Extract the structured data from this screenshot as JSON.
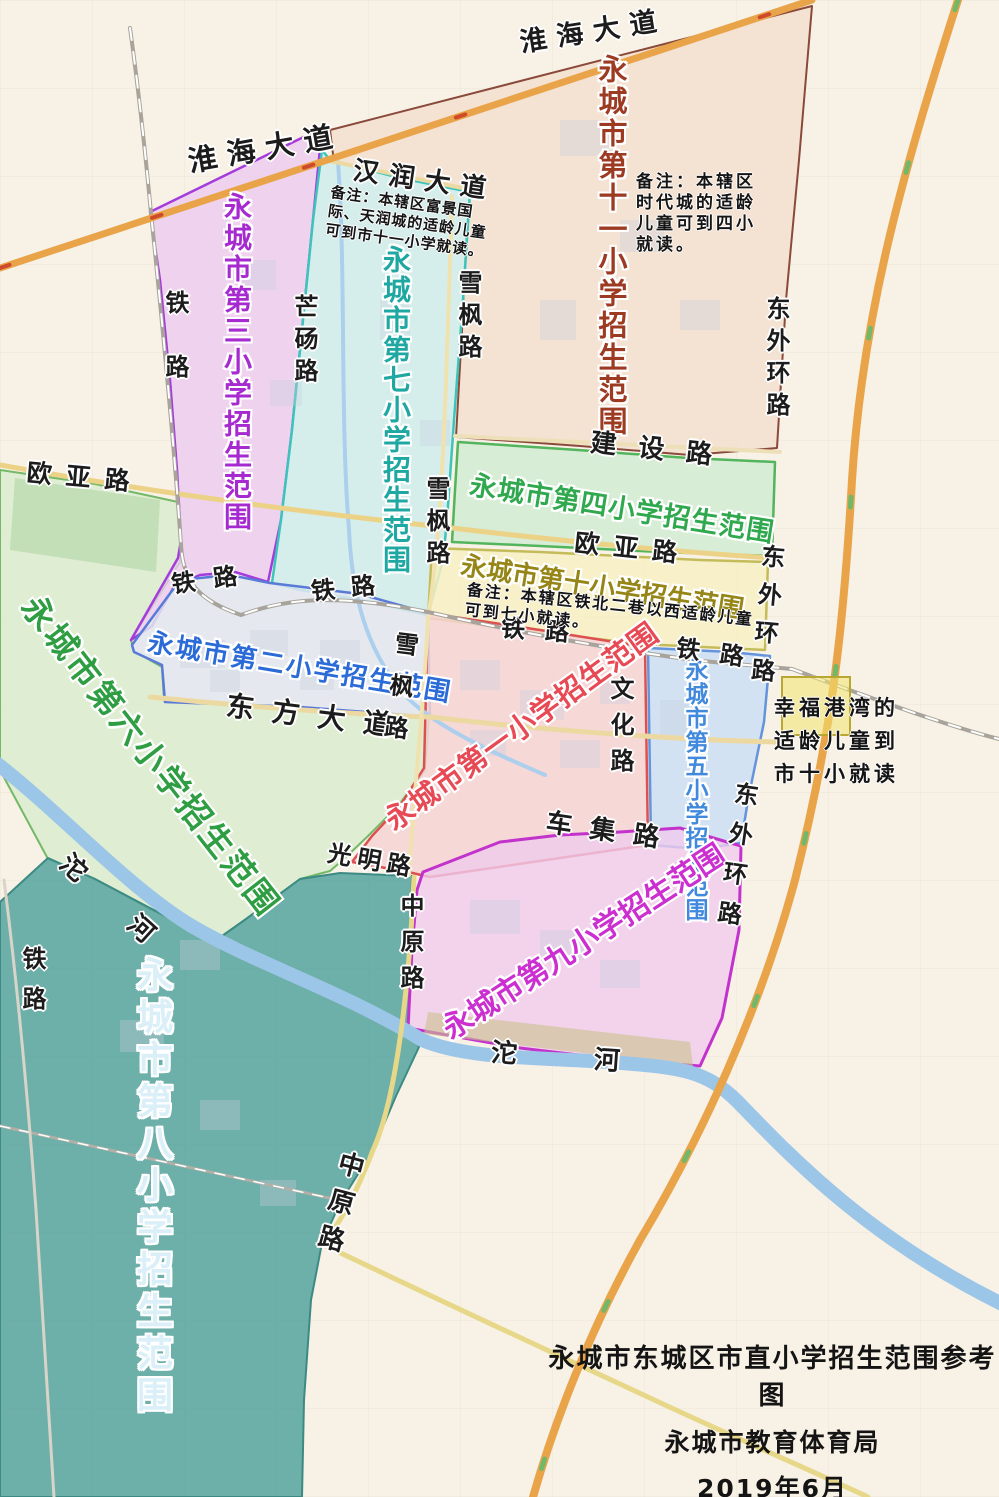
{
  "map_meta": {
    "width": 999,
    "height": 1497,
    "background": "#f8f1e6",
    "accent_orange_road": "#e9a44a",
    "river_color": "#9cc6e8"
  },
  "title_block": {
    "line1": "永城市东城区市直小学招生范围参考图",
    "line2": "永城市教育体育局",
    "line3": "2019年6月"
  },
  "zones": [
    {
      "id": "school-6",
      "name": "永城市第六小学招生范围",
      "fill": "#d5ecca",
      "opacity": 0.72,
      "stroke": "#74b868",
      "sw": 2,
      "points": "0,470 95,484 178,502 182,545 180,562 131,640 134,651 162,667 164,700 300,707 429,716 425,770 398,806 368,836 345,858 330,871 300,879 246,919 215,941 150,909 95,879 48,859 0,770",
      "label": {
        "text": "永城市第六小学招生范围",
        "color": "#2f9e43",
        "x": 42,
        "y": 590,
        "size": 33,
        "ls": 3,
        "rot": 52,
        "vert": false
      }
    },
    {
      "id": "school-8",
      "name": "永城市第八小学招生范围",
      "fill": "#55a39d",
      "opacity": 0.85,
      "stroke": "#3d8a84",
      "sw": 2,
      "points": "0,902 48,858 95,879 150,908 215,941 246,919 300,879 340,873 412,876 409,1030 419,1047 396,1096 373,1150 340,1203 322,1243 311,1300 304,1400 302,1497 0,1497",
      "label": {
        "text": "永城市第八小学招生范围",
        "color": "#daeff7",
        "x": 133,
        "y": 956,
        "size": 36,
        "ls": 6,
        "rot": 0,
        "vert": true
      }
    },
    {
      "id": "school-11",
      "name": "永城市第十一小学招生范围",
      "fill": "#f2dccc",
      "opacity": 0.72,
      "stroke": "#8a4a3a",
      "sw": 2,
      "points": "330,130 812,6 799,160 786,300 777,448 690,455 580,446 456,437 462,330 466,240 470,192 400,177 334,162",
      "label": {
        "text": "永城市第十一小学招生范围",
        "color": "#9c3a22",
        "x": 596,
        "y": 54,
        "size": 29,
        "ls": 3,
        "rot": 0,
        "vert": true
      }
    },
    {
      "id": "school-3",
      "name": "永城市第三小学招生范围",
      "fill": "#eccaf0",
      "opacity": 0.78,
      "stroke": "#a43cdc",
      "sw": 2.5,
      "points": "150,212 160,280 170,380 177,470 181,540 178,558 131,640 152,626 175,585 200,575 235,572 268,582 281,520 292,430 303,320 313,220 322,128",
      "label": {
        "text": "永城市第三小学招生范围",
        "color": "#a62ad0",
        "x": 222,
        "y": 192,
        "size": 28,
        "ls": 3,
        "rot": 0,
        "vert": true
      }
    },
    {
      "id": "school-7",
      "name": "永城市第七小学招生范围",
      "fill": "#cdeeec",
      "opacity": 0.8,
      "stroke": "#3cc4bc",
      "sw": 2.5,
      "points": "330,160 400,178 470,192 463,300 454,420 447,520 443,560 428,615 360,600 300,590 272,583 281,520 292,430 303,320 313,220 322,150",
      "label": {
        "text": "永城市第七小学招生范围",
        "color": "#1fa8a2",
        "x": 381,
        "y": 245,
        "size": 28,
        "ls": 2,
        "rot": 0,
        "vert": true
      }
    },
    {
      "id": "school-4",
      "name": "永城市第四小学招生范围",
      "fill": "#cfecd2",
      "opacity": 0.8,
      "stroke": "#52b45c",
      "sw": 2.5,
      "points": "458,442 578,450 688,458 775,462 772,556 660,552 540,546 452,542 455,490",
      "label": {
        "text": "永城市第四小学招生范围",
        "color": "#2fa84e",
        "x": 472,
        "y": 472,
        "size": 27,
        "ls": 1,
        "rot": 9,
        "vert": false
      }
    },
    {
      "id": "school-10",
      "name": "永城市第十小学招生范围",
      "fill": "#f7f0c2",
      "opacity": 0.85,
      "stroke": "#c4bc5a",
      "sw": 2.5,
      "points": "432,548 540,552 700,560 768,562 765,650 640,644 505,628 428,618",
      "label": {
        "text": "永城市第十小学招生范围",
        "color": "#968618",
        "x": 463,
        "y": 553,
        "size": 26,
        "ls": 0,
        "rot": 9,
        "vert": false
      }
    },
    {
      "id": "school-2",
      "name": "永城市第二小学招生范围",
      "fill": "#e2e7f0",
      "opacity": 0.85,
      "stroke": "#5a7ad8",
      "sw": 2.5,
      "points": "132,645 180,580 230,575 270,583 360,594 428,613 430,717 300,707 165,702 162,665 134,652",
      "label": {
        "text": "永城市第二小学招生范围",
        "color": "#2b6bd8",
        "x": 150,
        "y": 630,
        "size": 26,
        "ls": 2,
        "rot": 9.5,
        "vert": false
      }
    },
    {
      "id": "school-1",
      "name": "永城市第一小学招生范围",
      "fill": "#f6d3d3",
      "opacity": 0.85,
      "stroke": "#dc5050",
      "sw": 2.5,
      "points": "428,613 540,630 645,647 648,845 560,858 430,877 408,872 352,862 372,836 400,806 424,768",
      "label": {
        "text": "永城市第一小学招生范围",
        "color": "#e84a55",
        "x": 380,
        "y": 812,
        "size": 29,
        "ls": 1,
        "rot": -36,
        "vert": false
      }
    },
    {
      "id": "school-5",
      "name": "永城市第五小学招生范围",
      "fill": "#ccdff4",
      "opacity": 0.85,
      "stroke": "#6494dc",
      "sw": 2.5,
      "points": "648,648 730,652 770,656 764,722 748,800 741,843 700,849 651,845",
      "label": {
        "text": "永城市第五小学招生范围",
        "color": "#4189dc",
        "x": 682,
        "y": 658,
        "size": 23,
        "ls": 1,
        "rot": 0,
        "vert": true
      }
    },
    {
      "id": "school-9",
      "name": "永城市第九小学招生范围",
      "fill": "#f0ccec",
      "opacity": 0.8,
      "stroke": "#c233cc",
      "sw": 3,
      "points": "423,872 500,842 560,835 620,832 680,828 727,842 741,846 739,930 722,1018 700,1066 620,1060 520,1048 430,1032 408,1028 412,950 417,890",
      "label": {
        "text": "永城市第九小学招生范围",
        "color": "#cc2fd0",
        "x": 438,
        "y": 1020,
        "size": 30,
        "ls": 0,
        "rot": -33,
        "vert": false
      }
    }
  ],
  "rivers": [
    {
      "name": "tuo-river",
      "d": "M -5,762 C 60,812 125,885 190,925 C 258,965 340,990 422,1040 C 468,1060 545,1057 622,1063 C 680,1068 706,1070 738,1102 C 792,1158 868,1238 1004,1305",
      "color": "#9cc6e8",
      "w": 14
    },
    {
      "name": "stream",
      "d": "M 338,162 C 346,270 340,420 349,530 C 352,595 366,648 402,692 C 432,726 492,752 545,775",
      "color": "#abcfec",
      "w": 4
    }
  ],
  "roads": [
    {
      "name": "ouya-road",
      "d": "M 0,465 C 150,492 300,512 452,528 C 570,542 680,552 772,558",
      "color": "#ecd286",
      "w": 5
    },
    {
      "name": "jianshe-road",
      "d": "M 455,436 L 780,452",
      "color": "#ede0b8",
      "w": 4
    },
    {
      "name": "hanrun-avenue",
      "d": "M 330,161 L 472,190",
      "color": "#ecd9a2",
      "w": 4
    },
    {
      "name": "dongfang-avenue",
      "d": "M 150,697 C 300,712 420,717 430,717 C 560,732 690,740 775,742",
      "color": "#ecd9a2",
      "w": 5
    },
    {
      "name": "xuefeng-road",
      "d": "M 452,196 C 447,350 444,520 428,618 C 424,705 414,790 409,875",
      "color": "#f0e2ae",
      "w": 4
    },
    {
      "name": "zhongyuan-road-north",
      "d": "M 414,877 C 409,990 396,1100 373,1150 C 352,1205 331,1236 322,1244",
      "color": "#e7d788",
      "w": 5
    },
    {
      "name": "zhongyuan-road-south",
      "d": "M 322,1244 C 430,1296 540,1347 650,1398 C 740,1440 810,1470 868,1497",
      "color": "#e7d788",
      "w": 5
    },
    {
      "name": "railway-casing",
      "d": "M 130,28 C 140,100 146,160 151,213 C 161,310 173,430 181,545 C 183,583 200,601 241,615 C 282,600 330,592 428,612 C 520,633 622,651 702,661 L 792,669 C 855,692 940,724 999,739",
      "color": "#a8a49c",
      "w": 4
    },
    {
      "name": "railway-dashes",
      "d": "M 130,28 C 140,100 146,160 151,213 C 161,310 173,430 181,545 C 183,583 200,601 241,615 C 282,600 330,592 428,612 C 520,633 622,651 702,661 L 792,669 C 855,692 940,724 999,739",
      "color": "#ffffff",
      "w": 2,
      "dash": "12 12"
    },
    {
      "name": "railway-southwest-casing",
      "d": "M 0,1126 L 343,1201",
      "color": "#b0b0a8",
      "w": 3
    },
    {
      "name": "railway-southwest-dashes",
      "d": "M 0,1126 L 343,1201",
      "color": "#ffffff",
      "w": 1.5,
      "dash": "10 10"
    },
    {
      "name": "west-riverside-road",
      "d": "M 4,880 C 18,990 28,1100 36,1210 C 44,1330 50,1420 54,1497",
      "color": "#d8d4c8",
      "w": 3
    },
    {
      "name": "huaihai-avenue",
      "d": "M 0,268 L 812,0",
      "color": "#e9a44a",
      "w": 7
    },
    {
      "name": "huaihai-avenue-markers",
      "d": "M 0,268 L 812,0",
      "color": "#cf4a2a",
      "w": 4,
      "dash": "10 150"
    },
    {
      "name": "east-outer-ring-road",
      "d": "M 958,0 C 900,180 862,320 852,480 C 843,640 830,740 795,880 C 760,1010 700,1140 640,1240 C 590,1330 555,1420 533,1497",
      "color": "#e9a44a",
      "w": 8
    },
    {
      "name": "east-outer-ring-markers",
      "d": "M 958,0 C 900,180 862,320 852,480 C 843,640 830,740 795,880 C 760,1010 700,1140 640,1240 C 590,1330 555,1420 533,1497",
      "color": "#72b868",
      "w": 5,
      "dash": "10 160"
    }
  ],
  "road_labels": [
    {
      "text": "淮海大道",
      "x": 186,
      "y": 148,
      "size": 29,
      "ls": 10,
      "rot": -10,
      "vert": false
    },
    {
      "text": "淮海大道",
      "x": 518,
      "y": 30,
      "size": 27,
      "ls": 10,
      "rot": -9,
      "vert": false
    },
    {
      "text": "汉润大道",
      "x": 355,
      "y": 158,
      "size": 26,
      "ls": 10,
      "rot": 8,
      "vert": false
    },
    {
      "text": "建设路",
      "x": 592,
      "y": 430,
      "size": 26,
      "ls": 22,
      "rot": 6,
      "vert": false
    },
    {
      "text": "欧亚路",
      "x": 28,
      "y": 460,
      "size": 25,
      "ls": 14,
      "rot": 5,
      "vert": false
    },
    {
      "text": "欧亚路",
      "x": 576,
      "y": 530,
      "size": 25,
      "ls": 14,
      "rot": 6,
      "vert": false
    },
    {
      "text": "东方大道",
      "x": 228,
      "y": 692,
      "size": 28,
      "ls": 18,
      "rot": 7,
      "vert": false
    },
    {
      "text": "车集路",
      "x": 548,
      "y": 810,
      "size": 26,
      "ls": 18,
      "rot": 8,
      "vert": false
    },
    {
      "text": "光明路",
      "x": 330,
      "y": 841,
      "size": 24,
      "ls": 6,
      "rot": 10,
      "vert": false
    },
    {
      "text": "铁路",
      "x": 163,
      "y": 290,
      "size": 24,
      "ls": 40,
      "rot": 0,
      "vert": true
    },
    {
      "text": "铁路",
      "x": 170,
      "y": 573,
      "size": 24,
      "ls": 18,
      "rot": -8,
      "vert": false
    },
    {
      "text": "铁路",
      "x": 310,
      "y": 580,
      "size": 24,
      "ls": 16,
      "rot": -6,
      "vert": false
    },
    {
      "text": "铁路",
      "x": 502,
      "y": 616,
      "size": 24,
      "ls": 20,
      "rot": 4,
      "vert": false
    },
    {
      "text": "铁路",
      "x": 678,
      "y": 636,
      "size": 24,
      "ls": 20,
      "rot": 8,
      "vert": false
    },
    {
      "text": "铁路",
      "x": 20,
      "y": 946,
      "size": 24,
      "ls": 16,
      "rot": 0,
      "vert": true
    },
    {
      "text": "芒砀路",
      "x": 292,
      "y": 294,
      "size": 24,
      "ls": 8,
      "rot": 0,
      "vert": true
    },
    {
      "text": "雪枫路",
      "x": 456,
      "y": 270,
      "size": 24,
      "ls": 8,
      "rot": 0,
      "vert": true
    },
    {
      "text": "雪枫路",
      "x": 424,
      "y": 476,
      "size": 24,
      "ls": 8,
      "rot": 0,
      "vert": true
    },
    {
      "text": "雪枫路",
      "x": 394,
      "y": 630,
      "size": 24,
      "ls": 18,
      "rot": 7,
      "vert": true
    },
    {
      "text": "文化路",
      "x": 608,
      "y": 676,
      "size": 24,
      "ls": 12,
      "rot": 0,
      "vert": true
    },
    {
      "text": "中原路",
      "x": 398,
      "y": 893,
      "size": 24,
      "ls": 12,
      "rot": 0,
      "vert": true
    },
    {
      "text": "中原路",
      "x": 340,
      "y": 1148,
      "size": 26,
      "ls": 12,
      "rot": 15,
      "vert": true
    },
    {
      "text": "东外环路",
      "x": 764,
      "y": 296,
      "size": 24,
      "ls": 8,
      "rot": 0,
      "vert": true
    },
    {
      "text": "东外环路",
      "x": 760,
      "y": 543,
      "size": 24,
      "ls": 14,
      "rot": 5,
      "vert": true
    },
    {
      "text": "东外环路",
      "x": 734,
      "y": 780,
      "size": 24,
      "ls": 16,
      "rot": 8,
      "vert": true
    },
    {
      "text": "沱  河",
      "x": 72,
      "y": 850,
      "size": 26,
      "ls": 28,
      "rot": 42,
      "vert": false
    },
    {
      "text": "沱  河",
      "x": 492,
      "y": 1040,
      "size": 26,
      "ls": 34,
      "rot": 4,
      "vert": false
    }
  ],
  "notes": [
    {
      "id": "note-11",
      "x": 636,
      "y": 172,
      "rot": 0,
      "size": 17,
      "lh": 21,
      "ls": 3,
      "lines": [
        "备注：本辖区",
        "时代城的适龄",
        "儿童可到四小",
        "就读。"
      ]
    },
    {
      "id": "note-7-11",
      "x": 332,
      "y": 183,
      "rot": 8,
      "size": 15,
      "lh": 19,
      "ls": 1,
      "lines": [
        "备注：本辖区富景国",
        "际、天润城的适龄儿童",
        "可到市十一小学就读。"
      ]
    },
    {
      "id": "note-10",
      "x": 468,
      "y": 580,
      "rot": 6,
      "size": 16,
      "lh": 20,
      "ls": 2,
      "lines": [
        "备注：本辖区铁北二巷以西适龄儿童",
        "可到七小就读。"
      ]
    },
    {
      "id": "note-xingfu",
      "x": 774,
      "y": 692,
      "rot": 0,
      "size": 21,
      "lh": 33,
      "ls": 4,
      "lines": [
        "幸福港湾的",
        "适龄儿童到",
        "市十小就读"
      ]
    }
  ],
  "highlight_box": {
    "x": 781,
    "y": 676,
    "w": 66,
    "h": 56
  }
}
